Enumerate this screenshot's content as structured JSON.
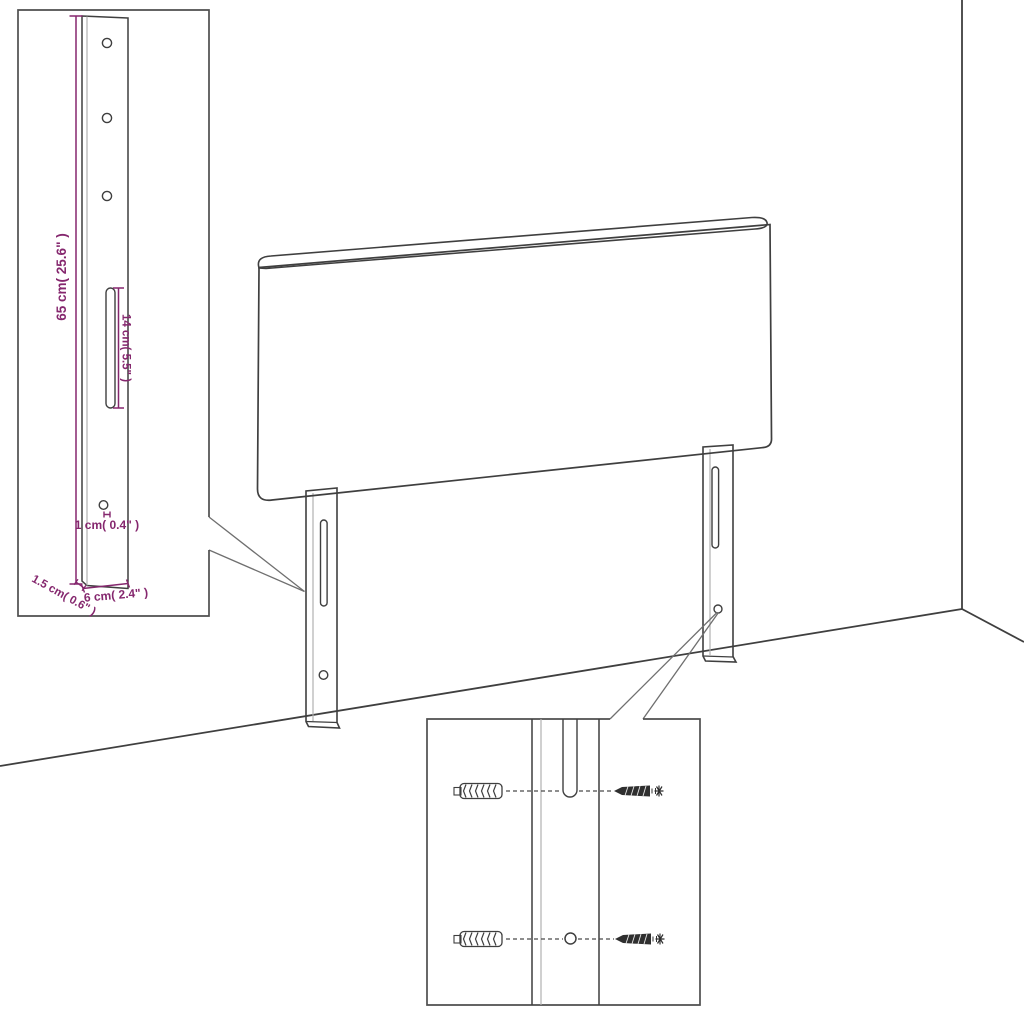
{
  "diagram": {
    "kind": "headboard assembly dimension diagram",
    "accent_color": "#85276e",
    "line_color": "#3f3f3f"
  },
  "bracket_inset": {
    "height_label": "65 cm( 25.6\" )",
    "slot_length_label": "14 cm( 5.5\" )",
    "hole_diameter_label": "1 cm( 0.4\" )",
    "thickness_label": "1.5 cm( 0.6\" )",
    "width_label": "6 cm( 2.4\" )",
    "hole_count": 3
  },
  "hardware_inset": {
    "rows": [
      {
        "left_icon": "wall-plug-icon",
        "target": "leg-slot",
        "right_icon": "screw-icon"
      },
      {
        "left_icon": "wall-plug-icon",
        "target": "leg-hole",
        "right_icon": "screw-icon"
      }
    ]
  }
}
